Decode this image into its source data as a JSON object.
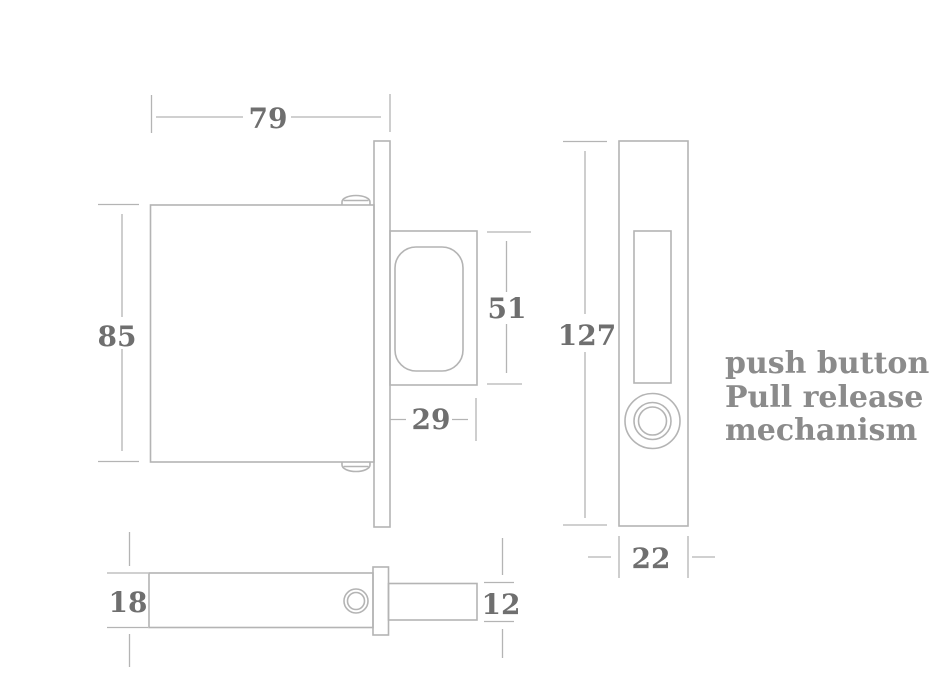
{
  "drawing": {
    "annotation": {
      "lines": [
        "push button",
        "Pull release",
        "mechanism"
      ]
    },
    "views": {
      "side": {
        "body_width": "79",
        "body_height": "85",
        "bolt_height": "51",
        "bolt_projection": "29"
      },
      "front": {
        "faceplate_height": "127",
        "faceplate_width": "22"
      },
      "bottom": {
        "case_thickness": "18",
        "bolt_thickness": "12"
      }
    },
    "colors": {
      "background": "#ffffff",
      "line": "#b4b4b4",
      "dimension_text": "#6f6f6f",
      "annotation_text": "#8b8b8b"
    }
  }
}
